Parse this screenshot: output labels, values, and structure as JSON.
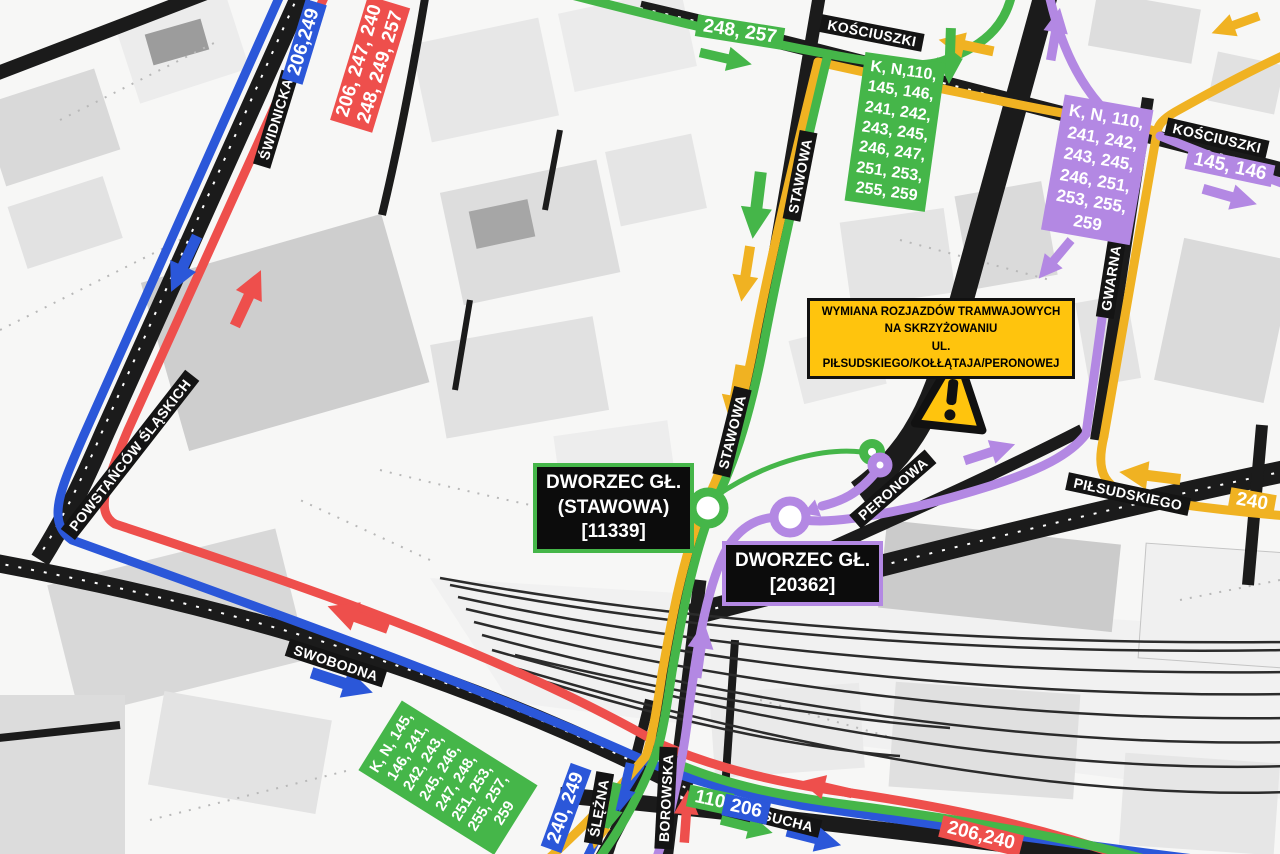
{
  "colors": {
    "blue": "#2b57d9",
    "red": "#ee4f4c",
    "green": "#45b649",
    "yellow": "#f0b222",
    "purple": "#b388e3",
    "warning-yellow": "#ffc40d",
    "label-bg": "#141414"
  },
  "streets": {
    "swidnicka": "ŚWIDNICKA",
    "kosciuszki": "KOŚCIUSZKI",
    "stawowa": "STAWOWA",
    "gwarna": "GWARNA",
    "pilsudskiego": "PIŁSUDSKIEGO",
    "peronowa": "PERONOWA",
    "powstancow_slaskich": "POWSTAŃCÓW ŚLĄSKICH",
    "swobodna": "SWOBODNA",
    "slezna": "ŚLĘŻNA",
    "borowska": "BOROWSKA",
    "sucha": "SUCHA"
  },
  "badges": {
    "swidnicka_blue": "206,249",
    "swidnicka_red_1": "206, 247, 240",
    "swidnicka_red_2": "248, 249, 257",
    "kosciuszki_green": "248, 257",
    "kosciuszki_purple": "145, 146",
    "pilsudskiego_yellow": "240",
    "slezna_blue": "240, 249",
    "sucha_green": "110",
    "sucha_blue": "206",
    "sucha_red": "206,240"
  },
  "route_boxes": {
    "stawowa_green": {
      "lines": [
        "K, N,110,",
        "145, 146,",
        "241, 242,",
        "243, 245,",
        "246, 247,",
        "251, 253,",
        "255, 259"
      ]
    },
    "gwarna_purple": {
      "lines": [
        "K, N, 110,",
        "241, 242,",
        "243, 245,",
        "246, 251,",
        "253, 255,",
        "259"
      ]
    },
    "swobodna_green": {
      "lines": [
        "K, N, 145,",
        "146, 241,",
        "242, 243,",
        "245, 246,",
        "247, 248,",
        "251, 253,",
        "255, 257,",
        "259"
      ]
    }
  },
  "warning": {
    "line1": "WYMIANA ROZJAZDÓW TRAMWAJOWYCH",
    "line2": "NA SKRZYŻOWANIU",
    "line3": "UL. PIŁSUDSKIEGO/KOŁŁĄTAJA/PERONOWEJ"
  },
  "stops": {
    "stawowa": {
      "name": "DWORZEC GŁ.",
      "name2": "(STAWOWA)",
      "code": "[11339]"
    },
    "peronowa": {
      "name": "DWORZEC GŁ.",
      "code": "[20362]"
    }
  }
}
